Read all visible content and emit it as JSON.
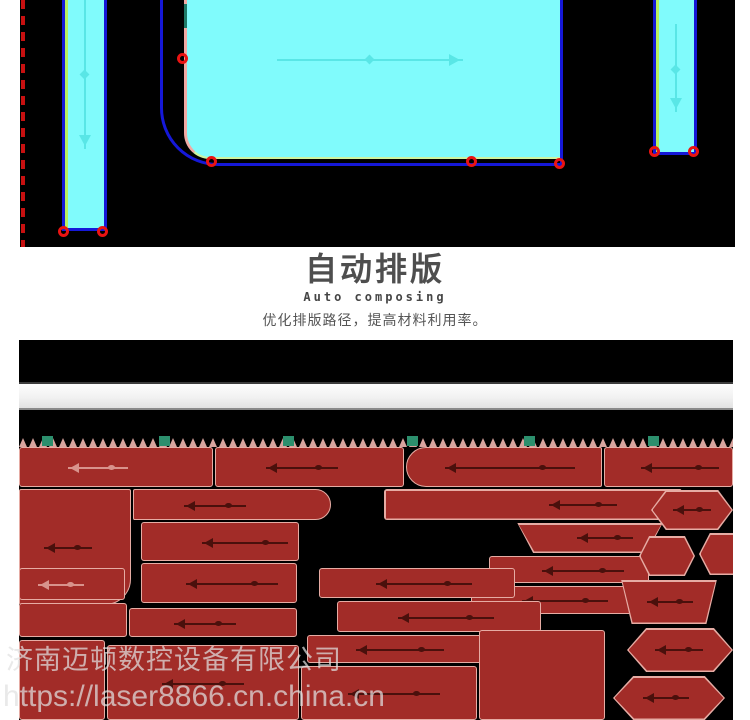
{
  "header": {
    "title": "自动排版",
    "subtitle": "Auto composing",
    "description": "优化排版路径，提高材料利用率。"
  },
  "watermark": {
    "line1": "济南迈顿数控设备有限公司",
    "line2": "https://laser8866.cn.china.cn"
  },
  "colors": {
    "cyan_fill": "#80fbfc",
    "blue_outline": "#1518d8",
    "green_edge": "#b9ef5f",
    "pink_edge": "#f2aaa4",
    "marker_red": "#ea1312",
    "dashed_red": "#c81010",
    "arrow_cyan": "#59e6e6",
    "part_fill": "#a22c28",
    "part_border": "#e6aca4",
    "arrow_dark": "#4a100c",
    "arrow_light": "#d8938c",
    "clamp_green": "#2c8f6d",
    "serration_pink": "#d9a49e"
  },
  "top_screenshot": {
    "markers": [
      {
        "x": 38,
        "y": 226
      },
      {
        "x": 77,
        "y": 226
      },
      {
        "x": 157,
        "y": 53
      },
      {
        "x": 186,
        "y": 156
      },
      {
        "x": 446,
        "y": 156
      },
      {
        "x": 534,
        "y": 158
      },
      {
        "x": 629,
        "y": 146
      },
      {
        "x": 668,
        "y": 146
      }
    ]
  },
  "bottom_screenshot": {
    "teeth_count": 72,
    "clamp_squares_x": [
      23,
      140,
      264,
      388,
      505,
      629
    ],
    "parts": [
      {
        "x": 0,
        "y": 107,
        "w": 194,
        "h": 40,
        "arrow": {
          "x": 48,
          "w": 60,
          "tone": "light"
        }
      },
      {
        "x": 196,
        "y": 107,
        "w": 189,
        "h": 40,
        "arrow": {
          "x": 50,
          "w": 72,
          "tone": "dark"
        }
      },
      {
        "x": 387,
        "y": 107,
        "w": 196,
        "h": 40,
        "r": "20px 2px 2px 20px",
        "arrow": {
          "x": 38,
          "w": 130,
          "tone": "dark"
        }
      },
      {
        "x": 585,
        "y": 107,
        "w": 129,
        "h": 40,
        "arrow": {
          "x": 36,
          "w": 78,
          "tone": "dark"
        }
      },
      {
        "x": 0,
        "y": 149,
        "w": 112,
        "h": 116,
        "r": "2px 2px 26px 2px",
        "arrow": {
          "x": 24,
          "w": 48,
          "tone": "dark"
        }
      },
      {
        "x": 114,
        "y": 149,
        "w": 198,
        "h": 31,
        "r": "2px 16px 16px 2px",
        "arrow": {
          "x": 50,
          "w": 62,
          "tone": "dark"
        }
      },
      {
        "x": 122,
        "y": 182,
        "w": 158,
        "h": 39,
        "arrow": {
          "x": 60,
          "w": 86,
          "tone": "dark"
        }
      },
      {
        "x": 122,
        "y": 223,
        "w": 156,
        "h": 40,
        "arrow": {
          "x": 44,
          "w": 92,
          "tone": "dark"
        }
      },
      {
        "x": 365,
        "y": 149,
        "w": 312,
        "h": 31,
        "clip": "trap-right",
        "arrow": {
          "x": 165,
          "w": 68,
          "tone": "dark"
        }
      },
      {
        "x": 492,
        "y": 183,
        "w": 158,
        "h": 30,
        "clip": "trap-down",
        "arrow": {
          "x": 66,
          "w": 56,
          "tone": "dark"
        }
      },
      {
        "x": 470,
        "y": 216,
        "w": 160,
        "h": 27,
        "arrow": {
          "x": 52,
          "w": 82,
          "tone": "dark"
        }
      },
      {
        "x": 452,
        "y": 246,
        "w": 166,
        "h": 28,
        "arrow": {
          "x": 50,
          "w": 86,
          "tone": "dark"
        }
      },
      {
        "x": 632,
        "y": 150,
        "w": 82,
        "h": 40,
        "clip": "hex",
        "arrow": {
          "x": 22,
          "w": 38,
          "tone": "dark"
        }
      },
      {
        "x": 680,
        "y": 193,
        "w": 60,
        "h": 42,
        "clip": "hex"
      },
      {
        "x": 620,
        "y": 196,
        "w": 56,
        "h": 40,
        "clip": "hex"
      },
      {
        "x": 598,
        "y": 240,
        "w": 104,
        "h": 44,
        "clip": "trap-down",
        "arrow": {
          "x": 30,
          "w": 46,
          "tone": "dark"
        }
      },
      {
        "x": 608,
        "y": 288,
        "w": 106,
        "h": 44,
        "clip": "hex",
        "arrow": {
          "x": 28,
          "w": 48,
          "tone": "dark"
        }
      },
      {
        "x": 594,
        "y": 336,
        "w": 112,
        "h": 44,
        "clip": "hex",
        "arrow": {
          "x": 30,
          "w": 46,
          "tone": "dark"
        }
      },
      {
        "x": 0,
        "y": 228,
        "w": 106,
        "h": 32,
        "arrow": {
          "x": 18,
          "w": 46,
          "tone": "light"
        }
      },
      {
        "x": 0,
        "y": 263,
        "w": 108,
        "h": 34
      },
      {
        "x": 110,
        "y": 268,
        "w": 168,
        "h": 29,
        "arrow": {
          "x": 44,
          "w": 62,
          "tone": "dark"
        }
      },
      {
        "x": 300,
        "y": 228,
        "w": 196,
        "h": 30,
        "arrow": {
          "x": 56,
          "w": 96,
          "tone": "dark"
        }
      },
      {
        "x": 318,
        "y": 261,
        "w": 204,
        "h": 31,
        "arrow": {
          "x": 60,
          "w": 96,
          "tone": "dark"
        }
      },
      {
        "x": 288,
        "y": 295,
        "w": 192,
        "h": 28,
        "arrow": {
          "x": 48,
          "w": 88,
          "tone": "dark"
        }
      },
      {
        "x": 0,
        "y": 300,
        "w": 86,
        "h": 80
      },
      {
        "x": 88,
        "y": 305,
        "w": 192,
        "h": 75,
        "arrow": {
          "x": 54,
          "w": 82,
          "tone": "dark"
        }
      },
      {
        "x": 282,
        "y": 326,
        "w": 176,
        "h": 54,
        "arrow": {
          "x": 46,
          "w": 92,
          "tone": "dark"
        }
      },
      {
        "x": 460,
        "y": 290,
        "w": 126,
        "h": 90
      }
    ]
  }
}
